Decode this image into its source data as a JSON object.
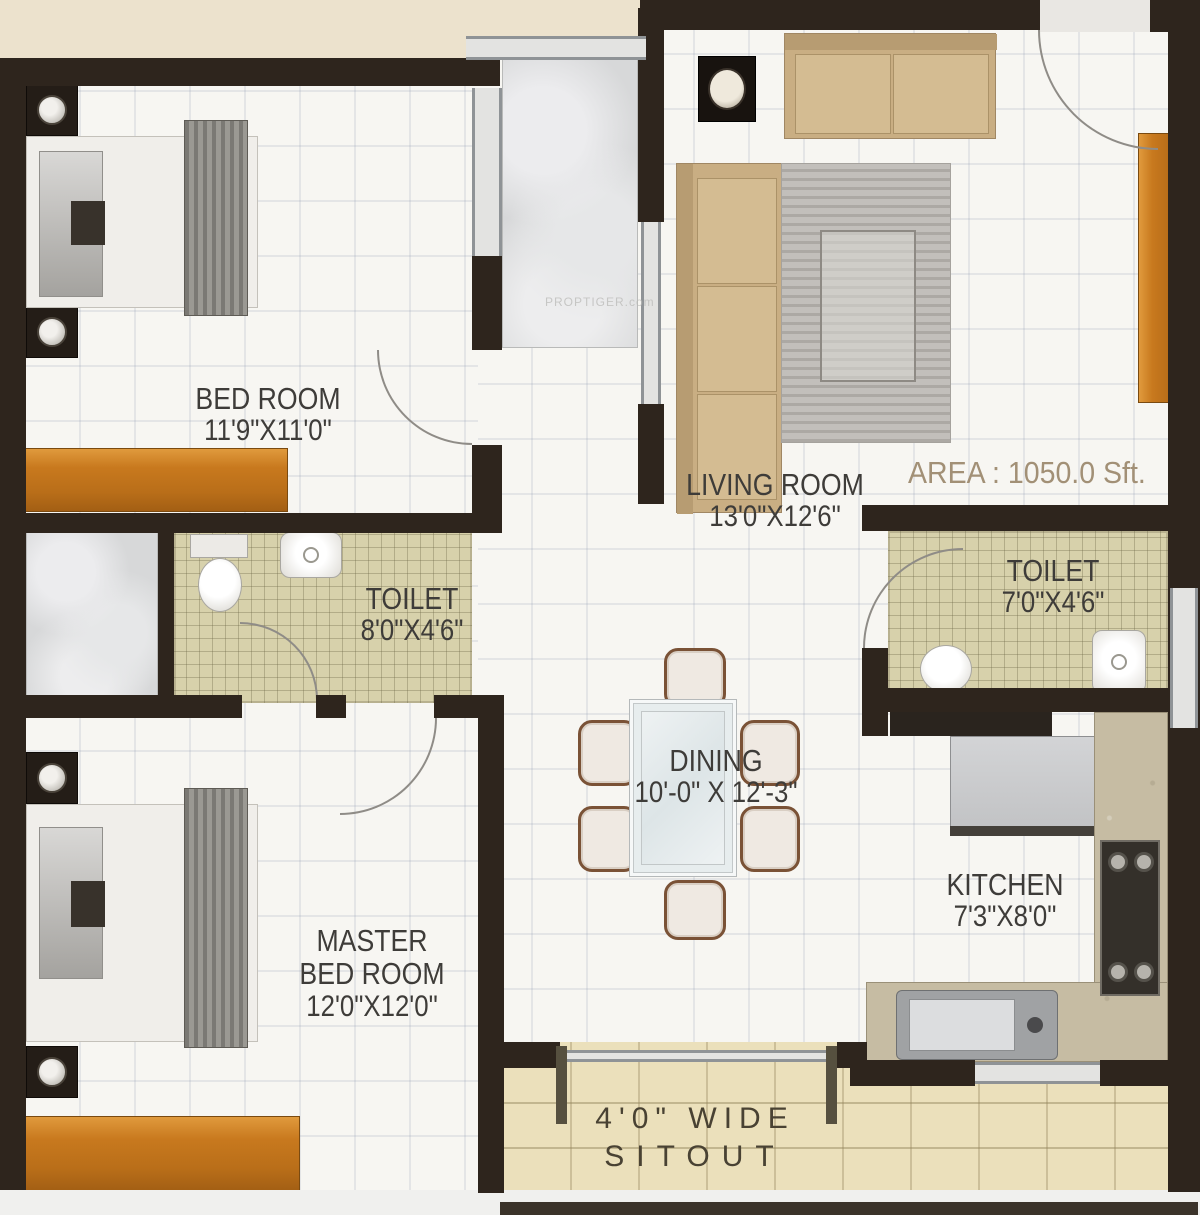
{
  "area_label": "AREA : 1050.0 Sft.",
  "watermark": "PROPTIGER.com",
  "rooms": {
    "bedroom": {
      "name": "BED ROOM",
      "dims": "11'9\"X11'0\""
    },
    "living": {
      "name": "LIVING ROOM",
      "dims": "13'0\"X12'6\""
    },
    "toilet_left": {
      "name": "TOILET",
      "dims": "8'0\"X4'6\""
    },
    "toilet_right": {
      "name": "TOILET",
      "dims": "7'0\"X4'6\""
    },
    "dining": {
      "name": "DINING",
      "dims": "10'-0\" X 12'-3\""
    },
    "kitchen": {
      "name": "KITCHEN",
      "dims": "7'3\"X8'0\""
    },
    "master": {
      "name_line1": "MASTER",
      "name_line2": "BED ROOM",
      "dims": "12'0\"X12'0\""
    },
    "sitout": {
      "line1": "4'0\" WIDE",
      "line2": "SITOUT"
    }
  },
  "colors": {
    "background_cream": "#ece2cd",
    "wall_dark": "#2e251d",
    "floor_white": "#f7f6f2",
    "toilet_tile": "#d7d1ab",
    "sitout_tile": "#ebe0bb",
    "marble_gray": "#d7d8d9",
    "furniture_wood_orange": "#c8791e",
    "sofa_tan": "#c9ae83",
    "rug_gray": "#c2bfbb",
    "label_text": "#3e3c39",
    "area_text": "#a29076",
    "chair_wood": "#7a5236"
  }
}
